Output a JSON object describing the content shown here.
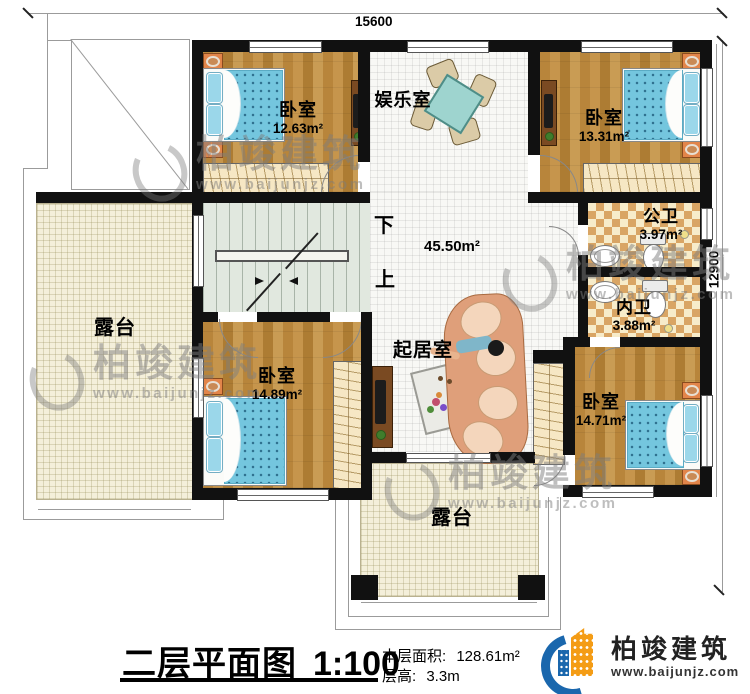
{
  "title": {
    "name": "二层平面图",
    "scale": "1:100",
    "area_label": "本层面积:",
    "area_value": "128.61m²",
    "floor_height_label": "层高:",
    "floor_height_value": "3.3m"
  },
  "dimensions": {
    "width_mm": "15600",
    "height_mm": "12900"
  },
  "rooms": [
    {
      "name": "卧室",
      "area": "12.63m²"
    },
    {
      "name": "娱乐室",
      "area": ""
    },
    {
      "name": "卧室",
      "area": "13.31m²"
    },
    {
      "name": "公卫",
      "area": "3.97m²"
    },
    {
      "name": "内卫",
      "area": "3.88m²"
    },
    {
      "name": "露台",
      "area": ""
    },
    {
      "name": "卧室",
      "area": "14.89m²"
    },
    {
      "name": "起居室",
      "area": ""
    },
    {
      "name": "卧室",
      "area": "14.71m²"
    },
    {
      "name": "露台",
      "area": ""
    }
  ],
  "hall": {
    "area": "45.50m²"
  },
  "stairs": {
    "down": "下",
    "up": "上"
  },
  "brand": {
    "name": "柏竣建筑",
    "website": "www.baijunjz.com"
  },
  "colors": {
    "wall": "#111111",
    "wood_floor": "#c08c42",
    "terrace_tile": "#f4efda",
    "checker_tan": "#d9a564",
    "bed_blue": "#74c6de",
    "logo_blue": "#1a67ad",
    "logo_orange": "#f49c15"
  }
}
